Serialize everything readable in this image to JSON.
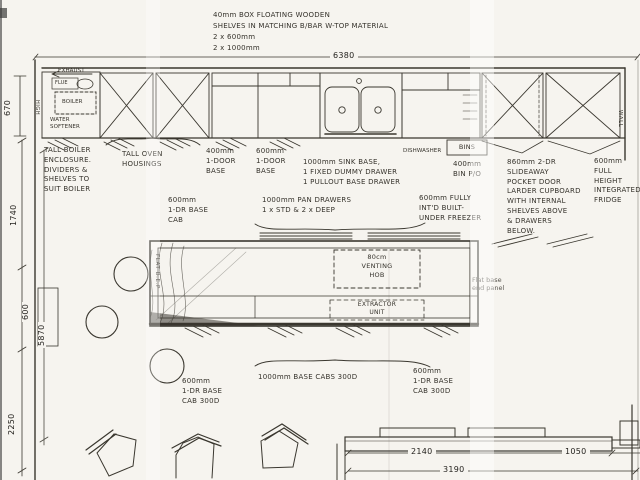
{
  "palette": {
    "paper": "#f6f4ef",
    "ink": "#3a372f",
    "faint": "#8a8781"
  },
  "top_note": {
    "text": "40mm BOX FLOATING WOODEN\nSHELVES IN MATCHING B/BAR W-TOP MATERIAL\n2 x 600mm\n2 x 1000mm"
  },
  "dims": {
    "overall": "6380",
    "d670": "670",
    "d1740": "1740",
    "d600": "600",
    "d5870": "5870",
    "d2250": "2250",
    "d2140": "2140",
    "d1050": "1050",
    "d3190": "3190"
  },
  "run": {
    "exhaust": "EXHAUST",
    "flue": "FLUE",
    "boiler": "BOILER",
    "water_softener": "WATER\nSOFTENER",
    "high": "HIGH",
    "wall": "WALL",
    "dishwasher": "DISHWASHER",
    "bins": "BINS"
  },
  "notes": {
    "boiler_enclosure": "TALL BOILER\nENCLOSURE.\nDIVIDERS &\nSHELVES TO\nSUIT BOILER",
    "oven_housings": "TALL OVEN\nHOUSINGS",
    "base_400": "400mm\n1-DOOR\nBASE",
    "base_600": "600mm\n1-DOOR\nBASE",
    "sink_base": "1000mm SINK BASE,\n1 FIXED DUMMY DRAWER\n1 PULLOUT BASE DRAWER",
    "bin_pullout": "400mm\nBIN P/O",
    "larder": "860mm 2-DR\nSLIDEAWAY\nPOCKET DOOR\nLARDER CUPBOARD\nWITH INTERNAL\nSHELVES ABOVE\n& DRAWERS\nBELOW.",
    "fridge": "600mm\nFULL\nHEIGHT\nINTEGRATED\nFRIDGE",
    "base_cab_mid": "600mm\n1-DR BASE\nCAB",
    "pan_drawers": "1000mm PAN DRAWERS\n1 x STD  &  2 x DEEP",
    "freezer": "600mm FULLY\nINT'D BUILT-\nUNDER FREEZER",
    "hob": "80cm\nVENTING\nHOB",
    "extractor": "EXTRACTOR\nUNIT",
    "flat_end_left": "FLAT B.E.P",
    "flat_end_right": "Flat base\nend panel",
    "base_cab_bl": "600mm\n1-DR BASE\nCAB 300D",
    "base_cabs_1000": "1000mm BASE CABS 300D",
    "base_cab_br": "600mm\n1-DR BASE\nCAB 300D"
  }
}
